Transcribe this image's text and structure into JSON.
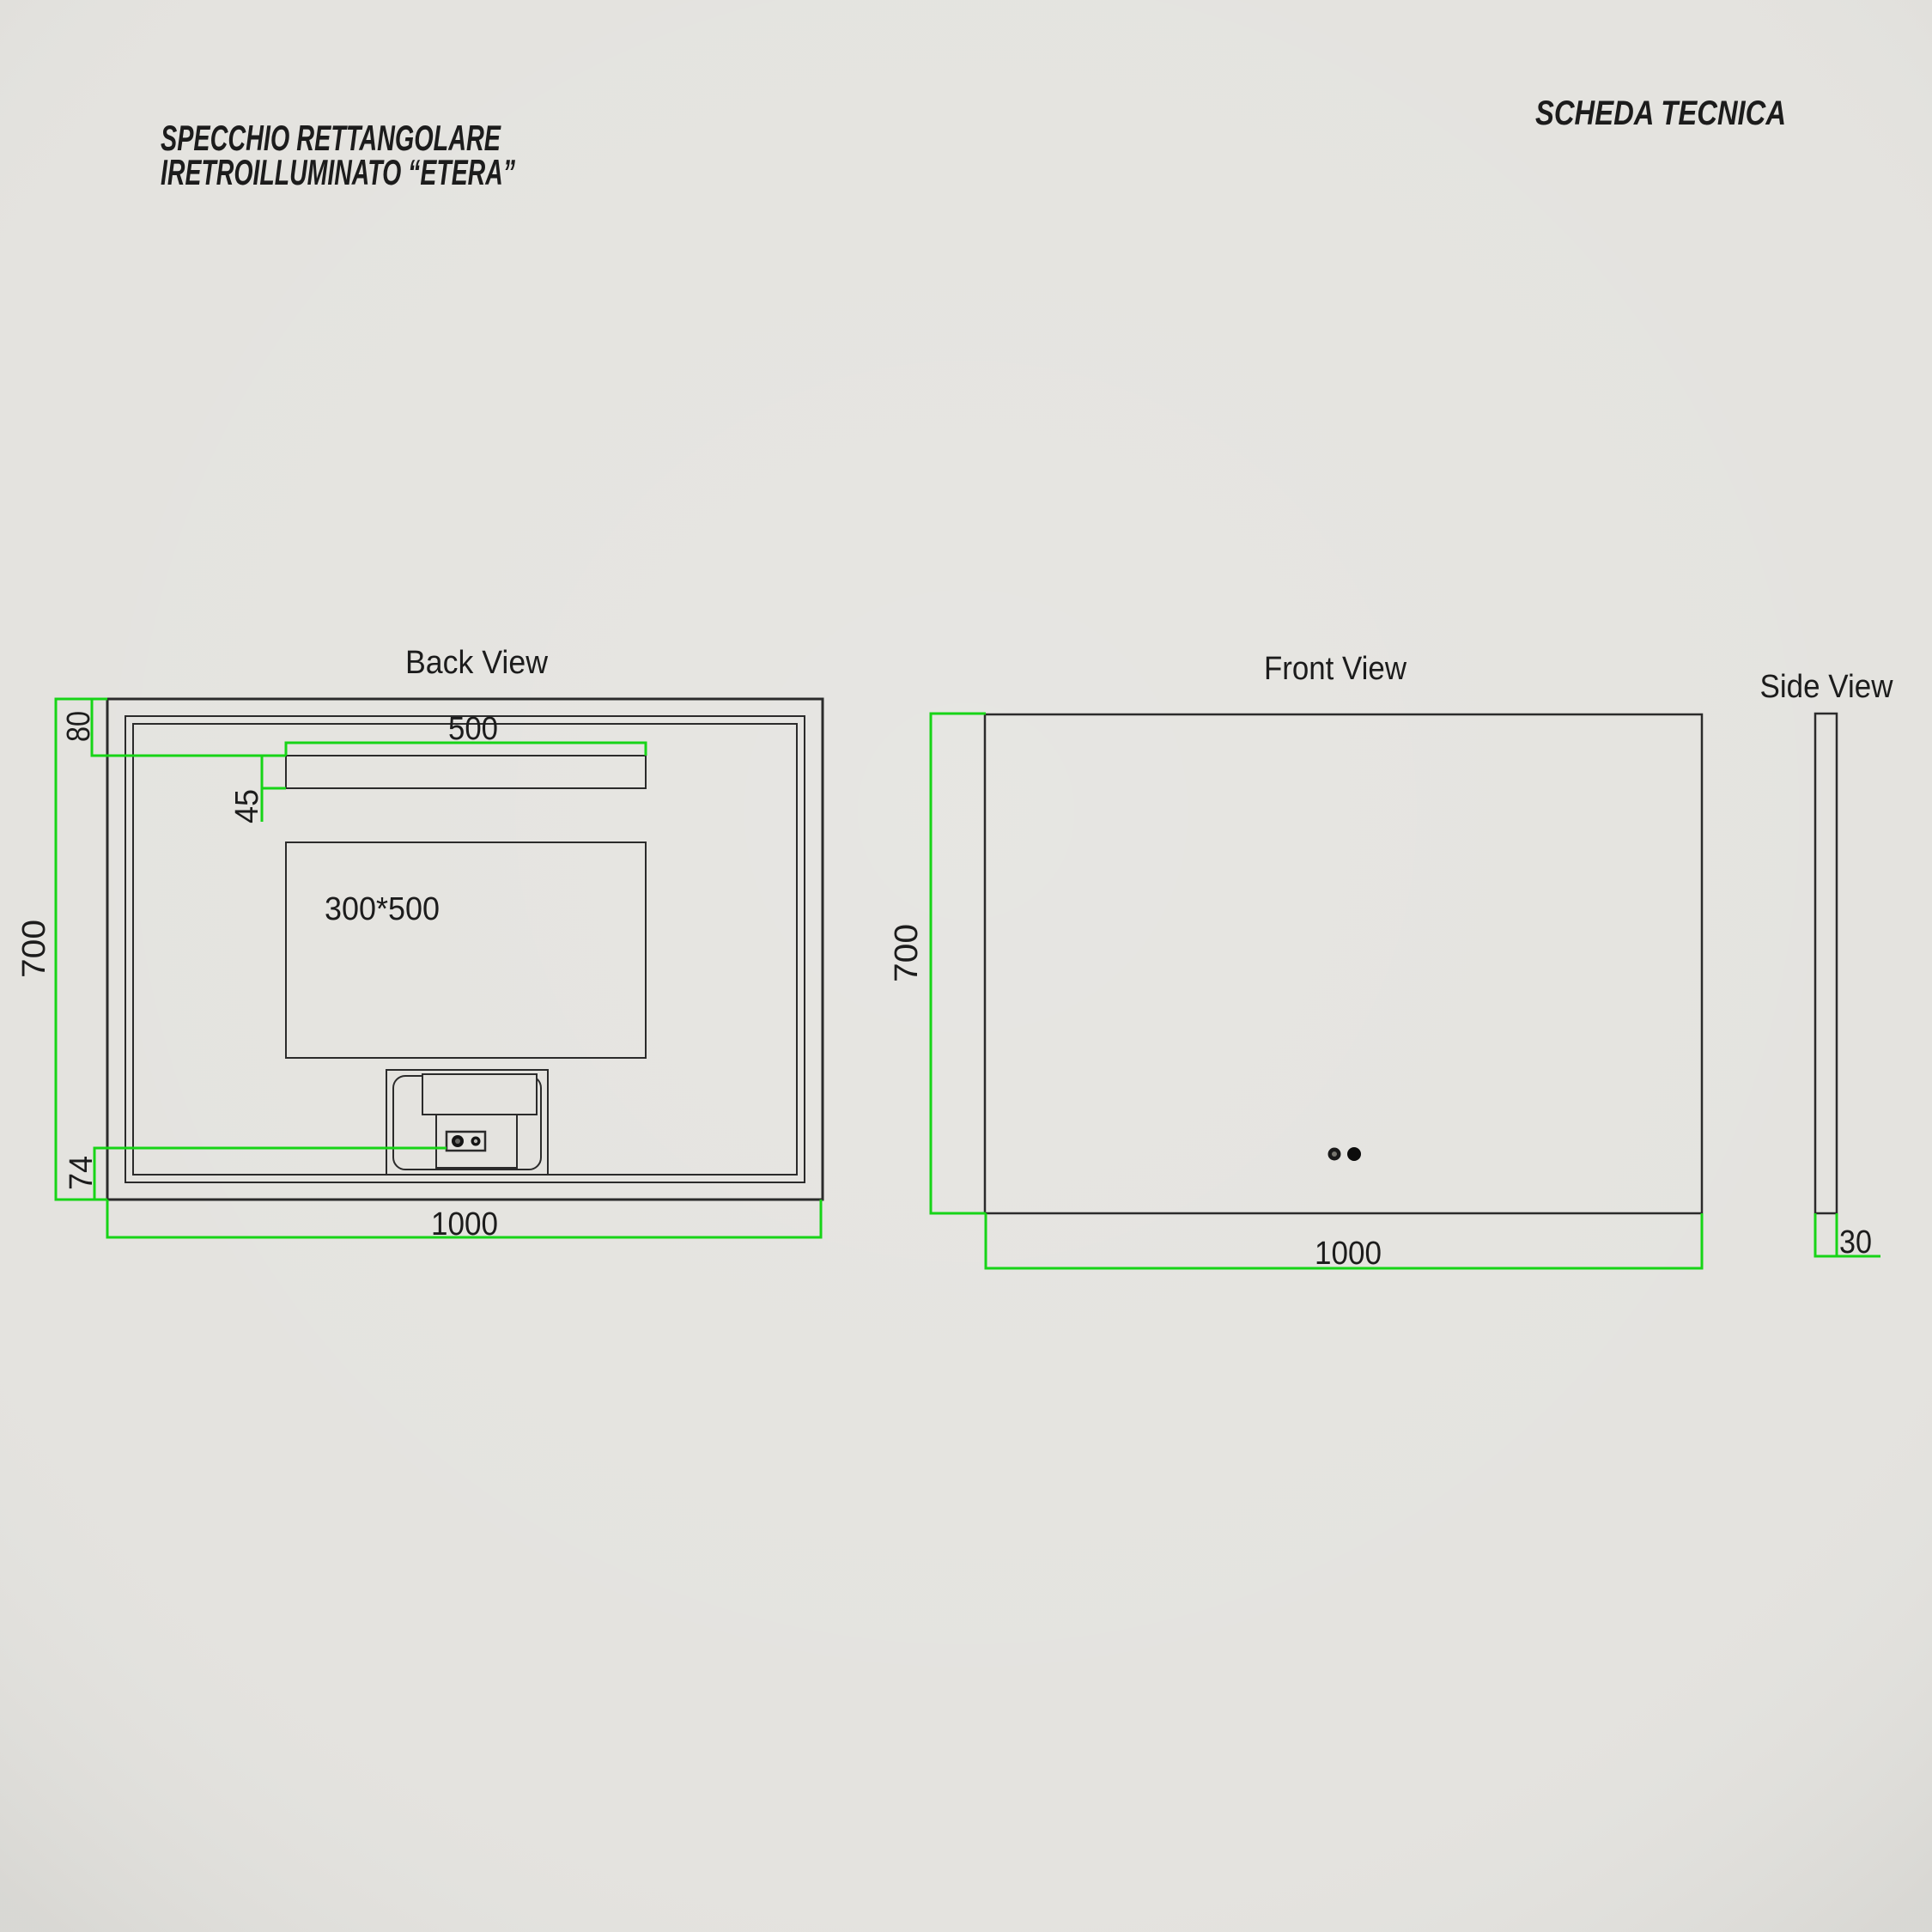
{
  "header": {
    "product_title_line1": "SPECCHIO RETTANGOLARE",
    "product_title_line2": "IRETROILLUMINATO “ETERA”",
    "doc_title": "SCHEDA TECNICA"
  },
  "views": {
    "back": {
      "title": "Back View",
      "driver_label": "300*500",
      "dims": {
        "offset_top": "80",
        "bar_width": "500",
        "bar_height": "45",
        "height": "700",
        "offset_bottom": "74",
        "width": "1000"
      }
    },
    "front": {
      "title": "Front View",
      "dims": {
        "height": "700",
        "width": "1000"
      }
    },
    "side": {
      "title": "Side View",
      "dims": {
        "thickness": "30"
      }
    }
  },
  "colors": {
    "background": "#e4e3df",
    "line": "#2b2b2b",
    "dimension": "#17d417",
    "text": "#1c1c1c"
  }
}
